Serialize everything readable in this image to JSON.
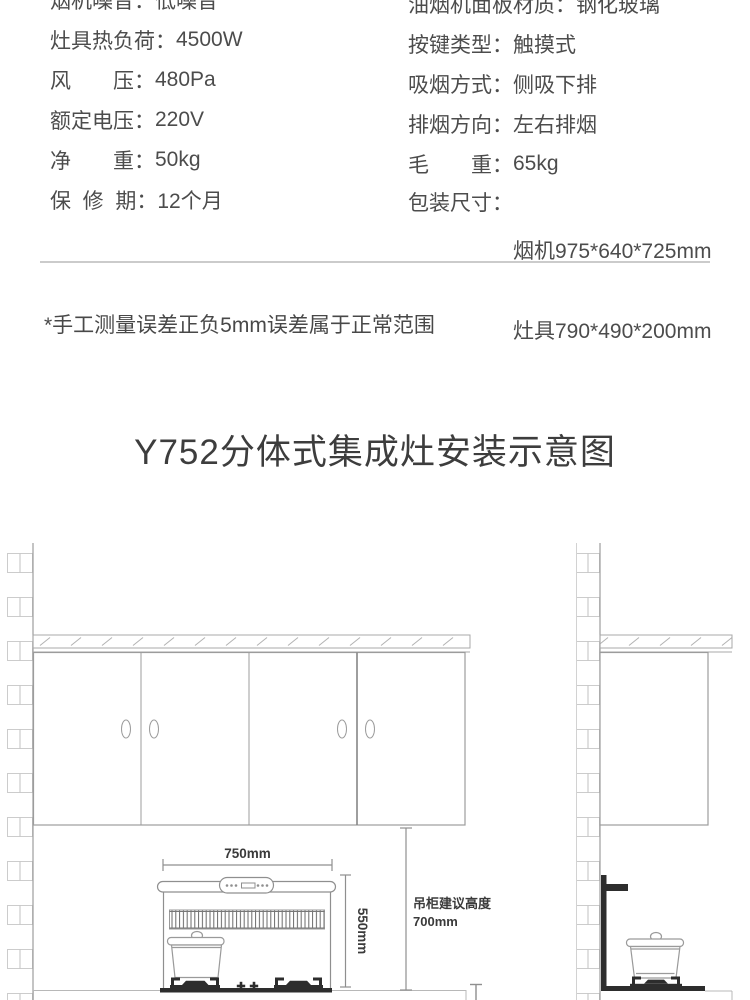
{
  "specs": {
    "left": [
      {
        "label": "烟机噪音：",
        "value": "低噪音"
      },
      {
        "label": "灶具热负荷：",
        "value": "4500W"
      },
      {
        "label": "风　　压：",
        "value": "480Pa"
      },
      {
        "label": "额定电压：",
        "value": "220V"
      },
      {
        "label": "净　　重：",
        "value": "50kg"
      },
      {
        "label": "保  修  期：",
        "value": "12个月"
      }
    ],
    "right": [
      {
        "label": "油烟机面板材质：",
        "value": "钢化玻璃"
      },
      {
        "label": "按键类型：",
        "value": "触摸式"
      },
      {
        "label": "吸烟方式：",
        "value": "侧吸下排"
      },
      {
        "label": "排烟方向：",
        "value": "左右排烟"
      },
      {
        "label": "毛　　重：",
        "value": "65kg"
      },
      {
        "label": "包装尺寸：",
        "value": "烟机975*640*725mm",
        "value2": "灶具790*490*200mm"
      }
    ]
  },
  "note": "*手工测量误差正负5mm误差属于正常范围",
  "section_title": "Y752分体式集成灶安装示意图",
  "diagram": {
    "hood_width_label": "750mm",
    "hood_height_label": "550mm",
    "cabinet_height_note_line1": "吊柜建议高度",
    "cabinet_height_note_line2": "700mm"
  },
  "colors": {
    "text_body": "#4c4c4c",
    "text_title": "#3d3d3d",
    "line_main": "#9c9c9c",
    "line_brick": "#cccccc",
    "dark_fixture": "#2d2d2d",
    "divider": "#cbcbcb"
  }
}
